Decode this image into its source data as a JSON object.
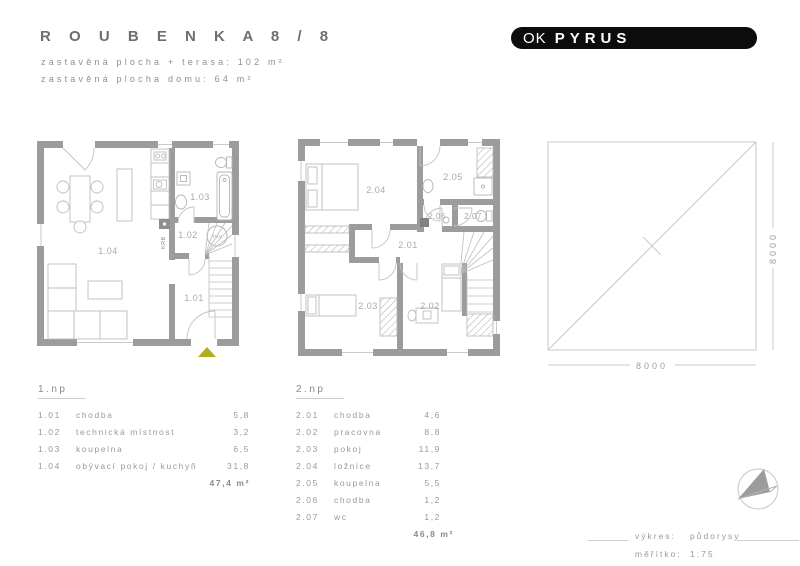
{
  "header": {
    "title": "R O U B E N K A   8 / 8",
    "subtitle1": "zastavěná plocha + terasa: 102 m²",
    "subtitle2": "zastavěná plocha domu: 64 m²"
  },
  "logo": {
    "ok": "OK",
    "pyrus": "PYRUS"
  },
  "plan1": {
    "labels": {
      "r101": "1.01",
      "r102": "1.02",
      "r103": "1.03",
      "r104": "1.04",
      "krb": "KRB",
      "tuv": "TUV"
    }
  },
  "plan2": {
    "labels": {
      "r201": "2.01",
      "r202": "2.02",
      "r203": "2.03",
      "r204": "2.04",
      "r205": "2.05",
      "r206": "2.06",
      "r207": "2.07"
    }
  },
  "plot": {
    "width_label": "8000",
    "height_label": "8000"
  },
  "legend1": {
    "floor": "1.np",
    "rows": [
      {
        "num": "1.01",
        "name": "chodba",
        "area": "5,8"
      },
      {
        "num": "1.02",
        "name": "technická místnost",
        "area": "3,2"
      },
      {
        "num": "1.03",
        "name": "koupelna",
        "area": "6,5"
      },
      {
        "num": "1.04",
        "name": "obývací pokoj / kuchyň",
        "area": "31,8"
      }
    ],
    "total": "47,4 m²"
  },
  "legend2": {
    "floor": "2.np",
    "rows": [
      {
        "num": "2.01",
        "name": "chodba",
        "area": "4,6"
      },
      {
        "num": "2.02",
        "name": "pracovna",
        "area": "8,8"
      },
      {
        "num": "2.03",
        "name": "pokoj",
        "area": "11,9"
      },
      {
        "num": "2.04",
        "name": "ložnice",
        "area": "13,7"
      },
      {
        "num": "2.05",
        "name": "koupelna",
        "area": "5,5"
      },
      {
        "num": "2.06",
        "name": "chodba",
        "area": "1,2"
      },
      {
        "num": "2.07",
        "name": "wc",
        "area": "1,2"
      }
    ],
    "total": "46,8 m²"
  },
  "titleblock": {
    "label1": "výkres:",
    "value1": "půdorysy",
    "label2": "měřítko:",
    "value2": "1:75"
  },
  "colors": {
    "wall": "#9c9c9c",
    "thin_line": "#c9c9c9",
    "furniture": "#bdbdbd",
    "accent_triangle": "#b5ad1e",
    "logo_bg": "#0c0c0c"
  }
}
